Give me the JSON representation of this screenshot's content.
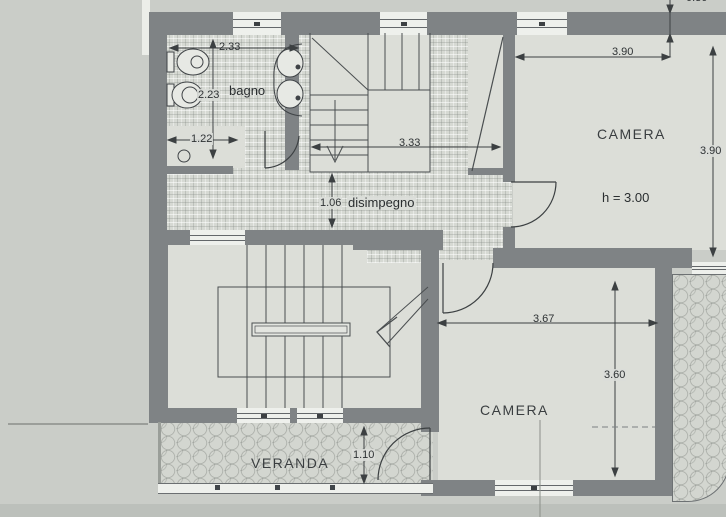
{
  "plan": {
    "title_hint": "first floor plan (pianta piano)",
    "rooms": {
      "bagno": {
        "label": "bagno"
      },
      "disimpegno": {
        "label": "disimpegno"
      },
      "camera_top": {
        "label": "CAMERA",
        "height_note": "h = 3.00"
      },
      "camera_bottom": {
        "label": "CAMERA"
      },
      "veranda": {
        "label": "VERANDA"
      }
    },
    "dimensions": {
      "bagno_width": "2.33",
      "bagno_depth": "2.23",
      "bagno_niche": "1.22",
      "stair_hall_width": "3.33",
      "disimpegno_width": "1.06",
      "camera_top_width": "3.90",
      "camera_top_depth": "3.90",
      "camera_bottom_width": "3.67",
      "camera_bottom_depth": "3.60",
      "veranda_depth": "1.10",
      "wall_thickness_partial": "0.30"
    },
    "colors": {
      "wall": "#7f8385",
      "floor": "#dcded8",
      "tile_floor": "#d6d9d3",
      "background": "#c9ccc7",
      "linework": "#3c4042"
    }
  }
}
